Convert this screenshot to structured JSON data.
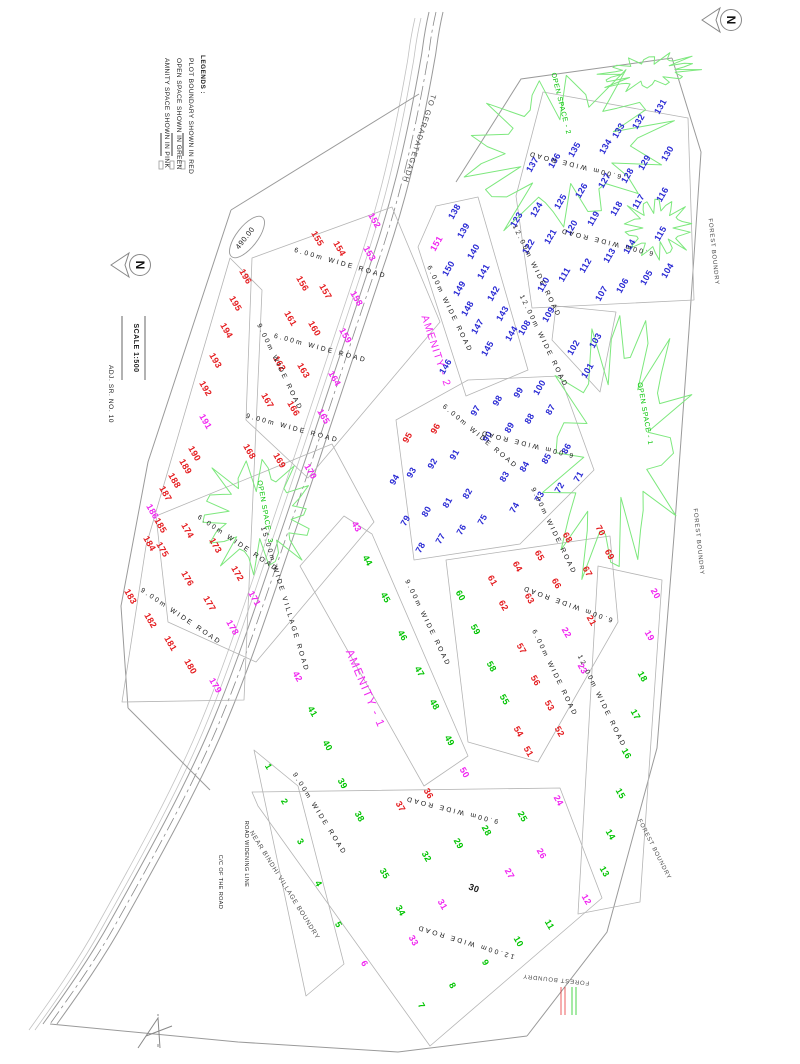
{
  "palette": {
    "b": "#2a2ad4",
    "r": "#e4191c",
    "g": "#00c400",
    "m": "#f024f0",
    "k": "#1a1a1a",
    "line": "#9a9a9a",
    "block": "#b4b4b4",
    "space": "#7de87d",
    "ink": "#222222",
    "gray": "#4a4a4a",
    "road_text": "#161616"
  },
  "legend": {
    "heading": "LEGENDS :",
    "items": [
      "PLOT BOUNDARY SHOWN IN RED",
      "OPEN SPACE SHOWN IN GREEN",
      "AMNITY SPACE SHOWN IN PINK"
    ]
  },
  "north": {
    "label": "N",
    "arrows": [
      {
        "x": 731,
        "y": 20
      },
      {
        "x": 140,
        "y": 265
      }
    ]
  },
  "scale": {
    "label": "SCALE  1:500"
  },
  "annotations": [
    {
      "t": "TO GERADATEGADH",
      "x": 417,
      "y": 138,
      "r": 108,
      "s": 7.5,
      "c": "gray",
      "ls": 1.2
    },
    {
      "t": "ADJ. SR. NO. 10",
      "x": 109,
      "y": 394,
      "r": 90,
      "s": 6.5,
      "c": "ink",
      "ls": 0.6
    },
    {
      "t": "FOREST BOUNDRY",
      "x": 712,
      "y": 252,
      "r": 84,
      "s": 6,
      "c": "gray",
      "ls": 0.8
    },
    {
      "t": "FOREST BOUNDRY",
      "x": 697,
      "y": 542,
      "r": 84,
      "s": 6,
      "c": "gray",
      "ls": 0.8
    },
    {
      "t": "FOREST BOUNDRY",
      "x": 653,
      "y": 850,
      "r": 63,
      "s": 6,
      "c": "gray",
      "ls": 0.8
    },
    {
      "t": "FOREST BOUNDRY",
      "x": 556,
      "y": 978,
      "r": -174,
      "s": 6,
      "c": "gray",
      "ls": 0.8
    },
    {
      "t": "NEAR BINDHI VILLAGE BOUNDRY",
      "x": 283,
      "y": 886,
      "r": 58,
      "s": 6.5,
      "c": "gray",
      "ls": 0.8
    },
    {
      "t": "C/C OF THE ROAD",
      "x": 219,
      "y": 882,
      "r": 90,
      "s": 5.5,
      "c": "ink",
      "ls": 0.4
    },
    {
      "t": "ROAD WIDENING LINE",
      "x": 245,
      "y": 854,
      "r": 90,
      "s": 5.5,
      "c": "ink",
      "ls": 0.4
    },
    {
      "t": "OPEN SPACE - 1",
      "x": 643,
      "y": 414,
      "r": 80,
      "s": 7,
      "c": "g",
      "ls": 0.6
    },
    {
      "t": "OPEN SPACE - 2",
      "x": 559,
      "y": 104,
      "r": 76,
      "s": 7,
      "c": "g",
      "ls": 0.6
    },
    {
      "t": "OPEN SPACE - 3",
      "x": 263,
      "y": 512,
      "r": 80,
      "s": 7,
      "c": "g",
      "ls": 0.6
    },
    {
      "t": "AMENITY - 1",
      "x": 362,
      "y": 690,
      "r": 67,
      "s": 11.5,
      "c": "m",
      "ls": 1.5
    },
    {
      "t": "AMENITY - 2",
      "x": 433,
      "y": 352,
      "r": 72,
      "s": 10.5,
      "c": "m",
      "ls": 1.2
    },
    {
      "t": "490.00",
      "x": 247,
      "y": 237,
      "r": -52,
      "s": 7.5,
      "c": "ink",
      "ls": 0.5,
      "e": 1
    },
    {
      "t": "SCALE  1:500",
      "x": 134,
      "y": 348,
      "r": 90,
      "s": 7,
      "c": "ink",
      "ls": 0.5,
      "w": 700
    }
  ],
  "road_labels": [
    {
      "t": "6.00m WIDE ROAD",
      "x": 340,
      "y": 265,
      "r": 16
    },
    {
      "t": "6.00m WIDE ROAD",
      "x": 320,
      "y": 350,
      "r": 15
    },
    {
      "t": "9.00m WIDE ROAD",
      "x": 292,
      "y": 430,
      "r": 15
    },
    {
      "t": "9.00m WIDE ROAD",
      "x": 278,
      "y": 368,
      "r": 64
    },
    {
      "t": "6.00m WIDE ROAD",
      "x": 237,
      "y": 545,
      "r": 34
    },
    {
      "t": "9.00m WIDE ROAD",
      "x": 180,
      "y": 618,
      "r": 34
    },
    {
      "t": "15.00m WIDE VILLAGE ROAD",
      "x": 283,
      "y": 600,
      "r": 73
    },
    {
      "t": "6.00m WIDE ROAD",
      "x": 448,
      "y": 310,
      "r": 64
    },
    {
      "t": "12.00m WIDE ROAD",
      "x": 542,
      "y": 342,
      "r": 64
    },
    {
      "t": "6.00m WIDE ROAD",
      "x": 575,
      "y": 163,
      "r": -166
    },
    {
      "t": "6.00m WIDE ROAD",
      "x": 607,
      "y": 240,
      "r": -166
    },
    {
      "t": "12.00m WIDE ROAD",
      "x": 535,
      "y": 272,
      "r": 64
    },
    {
      "t": "6.00m WIDE ROAD",
      "x": 479,
      "y": 438,
      "r": 40
    },
    {
      "t": "6.00m WIDE ROAD",
      "x": 527,
      "y": 442,
      "r": -166
    },
    {
      "t": "9.00m WIDE ROAD",
      "x": 552,
      "y": 532,
      "r": 64
    },
    {
      "t": "9.00m WIDE ROAD",
      "x": 426,
      "y": 624,
      "r": 64
    },
    {
      "t": "6.00m WIDE ROAD",
      "x": 568,
      "y": 602,
      "r": -160
    },
    {
      "t": "6.00m WIDE ROAD",
      "x": 553,
      "y": 674,
      "r": 64
    },
    {
      "t": "12.00m WIDE ROAD",
      "x": 600,
      "y": 702,
      "r": 64
    },
    {
      "t": "9.00m WIDE ROAD",
      "x": 452,
      "y": 808,
      "r": -166
    },
    {
      "t": "12.00m WIDE ROAD",
      "x": 466,
      "y": 940,
      "r": -163
    },
    {
      "t": "9.00m WIDE ROAD",
      "x": 318,
      "y": 815,
      "r": 58
    }
  ],
  "plots": {
    "items": [
      [
        1,
        266,
        768,
        "g"
      ],
      [
        2,
        282,
        803,
        "g"
      ],
      [
        3,
        298,
        843,
        "g"
      ],
      [
        4,
        316,
        885,
        "g"
      ],
      [
        5,
        336,
        926,
        "g"
      ],
      [
        6,
        362,
        965,
        "m"
      ],
      [
        7,
        419,
        1007,
        "g"
      ],
      [
        8,
        450,
        987,
        "g"
      ],
      [
        9,
        483,
        964,
        "g"
      ],
      [
        10,
        516,
        943,
        "g"
      ],
      [
        11,
        547,
        926,
        "g"
      ],
      [
        12,
        584,
        901,
        "m"
      ],
      [
        13,
        602,
        873,
        "g"
      ],
      [
        14,
        608,
        836,
        "g"
      ],
      [
        15,
        618,
        795,
        "g"
      ],
      [
        16,
        624,
        755,
        "g"
      ],
      [
        17,
        633,
        716,
        "g"
      ],
      [
        18,
        640,
        678,
        "g"
      ],
      [
        19,
        647,
        637,
        "m"
      ],
      [
        20,
        653,
        595,
        "m"
      ],
      [
        21,
        589,
        622,
        "r"
      ],
      [
        22,
        564,
        634,
        "m"
      ],
      [
        23,
        580,
        670,
        "m"
      ],
      [
        24,
        556,
        802,
        "m"
      ],
      [
        25,
        520,
        818,
        "g"
      ],
      [
        26,
        539,
        855,
        "m"
      ],
      [
        27,
        507,
        875,
        "m"
      ],
      [
        28,
        484,
        832,
        "g"
      ],
      [
        29,
        456,
        845,
        "g"
      ],
      [
        30,
        473,
        891,
        "k"
      ],
      [
        31,
        440,
        906,
        "m"
      ],
      [
        32,
        424,
        858,
        "g"
      ],
      [
        33,
        411,
        942,
        "m"
      ],
      [
        34,
        398,
        912,
        "g"
      ],
      [
        35,
        382,
        875,
        "g"
      ],
      [
        36,
        426,
        795,
        "r"
      ],
      [
        37,
        398,
        808,
        "r"
      ],
      [
        38,
        357,
        818,
        "g"
      ],
      [
        39,
        340,
        785,
        "g"
      ],
      [
        40,
        325,
        747,
        "g"
      ],
      [
        41,
        310,
        713,
        "g"
      ],
      [
        42,
        295,
        678,
        "m"
      ],
      [
        43,
        354,
        528,
        "m"
      ],
      [
        44,
        365,
        562,
        "g"
      ],
      [
        45,
        383,
        599,
        "g"
      ],
      [
        46,
        400,
        637,
        "g"
      ],
      [
        47,
        417,
        673,
        "g"
      ],
      [
        48,
        432,
        706,
        "g"
      ],
      [
        49,
        447,
        742,
        "g"
      ],
      [
        50,
        462,
        774,
        "m"
      ],
      [
        51,
        526,
        753,
        "r"
      ],
      [
        52,
        557,
        733,
        "r"
      ],
      [
        53,
        547,
        707,
        "r"
      ],
      [
        54,
        516,
        733,
        "r"
      ],
      [
        55,
        502,
        701,
        "g"
      ],
      [
        56,
        533,
        682,
        "r"
      ],
      [
        57,
        519,
        650,
        "r"
      ],
      [
        58,
        489,
        668,
        "g"
      ],
      [
        59,
        473,
        631,
        "g"
      ],
      [
        60,
        458,
        597,
        "g"
      ],
      [
        61,
        490,
        582,
        "r"
      ],
      [
        62,
        501,
        607,
        "r"
      ],
      [
        63,
        527,
        600,
        "r"
      ],
      [
        64,
        515,
        568,
        "r"
      ],
      [
        65,
        537,
        557,
        "r"
      ],
      [
        66,
        554,
        585,
        "r"
      ],
      [
        67,
        585,
        573,
        "r"
      ],
      [
        68,
        565,
        539,
        "r"
      ],
      [
        69,
        607,
        556,
        "r"
      ],
      [
        70,
        598,
        532,
        "r"
      ],
      [
        71,
        581,
        478,
        "b"
      ],
      [
        72,
        562,
        489,
        "b"
      ],
      [
        73,
        542,
        498,
        "b"
      ],
      [
        74,
        517,
        509,
        "b"
      ],
      [
        75,
        485,
        521,
        "b"
      ],
      [
        76,
        464,
        531,
        "b"
      ],
      [
        77,
        443,
        540,
        "b"
      ],
      [
        78,
        423,
        549,
        "b"
      ],
      [
        79,
        408,
        522,
        "b"
      ],
      [
        80,
        429,
        513,
        "b"
      ],
      [
        81,
        450,
        504,
        "b"
      ],
      [
        82,
        470,
        495,
        "b"
      ],
      [
        83,
        507,
        478,
        "b"
      ],
      [
        84,
        527,
        468,
        "b"
      ],
      [
        85,
        549,
        460,
        "b"
      ],
      [
        86,
        569,
        450,
        "b"
      ],
      [
        87,
        553,
        411,
        "b"
      ],
      [
        88,
        532,
        420,
        "b"
      ],
      [
        89,
        512,
        429,
        "b"
      ],
      [
        90,
        490,
        438,
        "b"
      ],
      [
        91,
        457,
        456,
        "b"
      ],
      [
        92,
        435,
        465,
        "b"
      ],
      [
        93,
        414,
        474,
        "b"
      ],
      [
        94,
        397,
        481,
        "b"
      ],
      [
        95,
        410,
        439,
        "r"
      ],
      [
        96,
        438,
        430,
        "r"
      ],
      [
        97,
        478,
        412,
        "b"
      ],
      [
        98,
        500,
        402,
        "b"
      ],
      [
        99,
        521,
        394,
        "b"
      ],
      [
        100,
        542,
        389,
        "b"
      ],
      [
        101,
        590,
        372,
        "b"
      ],
      [
        102,
        576,
        349,
        "b"
      ],
      [
        103,
        598,
        342,
        "b"
      ],
      [
        104,
        670,
        272,
        "b"
      ],
      [
        105,
        649,
        279,
        "b"
      ],
      [
        106,
        625,
        287,
        "b"
      ],
      [
        107,
        604,
        295,
        "b"
      ],
      [
        108,
        527,
        329,
        "b"
      ],
      [
        109,
        551,
        316,
        "b"
      ],
      [
        110,
        546,
        286,
        "b"
      ],
      [
        111,
        567,
        276,
        "b"
      ],
      [
        112,
        588,
        267,
        "b"
      ],
      [
        113,
        612,
        257,
        "b"
      ],
      [
        114,
        632,
        248,
        "b"
      ],
      [
        115,
        663,
        235,
        "b"
      ],
      [
        116,
        665,
        196,
        "b"
      ],
      [
        117,
        641,
        203,
        "b"
      ],
      [
        118,
        619,
        210,
        "b"
      ],
      [
        119,
        596,
        220,
        "b"
      ],
      [
        120,
        574,
        229,
        "b"
      ],
      [
        121,
        553,
        238,
        "b"
      ],
      [
        122,
        531,
        248,
        "b"
      ],
      [
        123,
        519,
        221,
        "b"
      ],
      [
        124,
        539,
        211,
        "b"
      ],
      [
        125,
        563,
        203,
        "b"
      ],
      [
        126,
        584,
        192,
        "b"
      ],
      [
        127,
        607,
        182,
        "b"
      ],
      [
        128,
        630,
        177,
        "b"
      ],
      [
        129,
        647,
        164,
        "b"
      ],
      [
        130,
        670,
        155,
        "b"
      ],
      [
        131,
        663,
        108,
        "b"
      ],
      [
        132,
        641,
        123,
        "b"
      ],
      [
        133,
        621,
        132,
        "b"
      ],
      [
        134,
        608,
        148,
        "b"
      ],
      [
        135,
        577,
        151,
        "b"
      ],
      [
        136,
        557,
        162,
        "b"
      ],
      [
        137,
        535,
        166,
        "b"
      ],
      [
        138,
        457,
        213,
        "b"
      ],
      [
        139,
        466,
        232,
        "b"
      ],
      [
        140,
        476,
        253,
        "b"
      ],
      [
        141,
        486,
        273,
        "b"
      ],
      [
        142,
        496,
        295,
        "b"
      ],
      [
        143,
        505,
        315,
        "b"
      ],
      [
        144,
        514,
        335,
        "b"
      ],
      [
        145,
        490,
        350,
        "b"
      ],
      [
        146,
        448,
        368,
        "b"
      ],
      [
        147,
        480,
        328,
        "b"
      ],
      [
        148,
        470,
        310,
        "b"
      ],
      [
        149,
        462,
        290,
        "b"
      ],
      [
        150,
        451,
        270,
        "b"
      ],
      [
        151,
        439,
        245,
        "m"
      ],
      [
        152,
        372,
        222,
        "m"
      ],
      [
        153,
        367,
        255,
        "m"
      ],
      [
        154,
        337,
        250,
        "r"
      ],
      [
        155,
        315,
        240,
        "r"
      ],
      [
        156,
        300,
        285,
        "r"
      ],
      [
        157,
        323,
        293,
        "r"
      ],
      [
        158,
        354,
        300,
        "m"
      ],
      [
        159,
        343,
        337,
        "m"
      ],
      [
        160,
        312,
        330,
        "r"
      ],
      [
        161,
        288,
        320,
        "r"
      ],
      [
        162,
        277,
        365,
        "r"
      ],
      [
        163,
        301,
        372,
        "r"
      ],
      [
        164,
        332,
        380,
        "m"
      ],
      [
        165,
        321,
        418,
        "m"
      ],
      [
        166,
        291,
        410,
        "r"
      ],
      [
        167,
        265,
        402,
        "r"
      ],
      [
        168,
        247,
        453,
        "r"
      ],
      [
        169,
        277,
        462,
        "r"
      ],
      [
        170,
        308,
        473,
        "m"
      ],
      [
        171,
        252,
        600,
        "m"
      ],
      [
        172,
        235,
        575,
        "r"
      ],
      [
        173,
        213,
        547,
        "r"
      ],
      [
        174,
        185,
        532,
        "r"
      ],
      [
        175,
        160,
        551,
        "r"
      ],
      [
        176,
        185,
        580,
        "r"
      ],
      [
        177,
        207,
        605,
        "r"
      ],
      [
        178,
        230,
        629,
        "m"
      ],
      [
        179,
        213,
        687,
        "m"
      ],
      [
        180,
        188,
        668,
        "r"
      ],
      [
        181,
        168,
        645,
        "r"
      ],
      [
        182,
        148,
        622,
        "r"
      ],
      [
        183,
        128,
        598,
        "r"
      ],
      [
        184,
        147,
        545,
        "r"
      ],
      [
        185,
        158,
        527,
        "r"
      ],
      [
        186,
        150,
        513,
        "m"
      ],
      [
        187,
        163,
        495,
        "r"
      ],
      [
        188,
        172,
        482,
        "r"
      ],
      [
        189,
        183,
        468,
        "r"
      ],
      [
        190,
        192,
        455,
        "r"
      ],
      [
        191,
        203,
        423,
        "m"
      ],
      [
        192,
        203,
        390,
        "r"
      ],
      [
        193,
        213,
        362,
        "r"
      ],
      [
        194,
        224,
        332,
        "r"
      ],
      [
        195,
        233,
        305,
        "r"
      ],
      [
        196,
        243,
        278,
        "r"
      ]
    ]
  }
}
